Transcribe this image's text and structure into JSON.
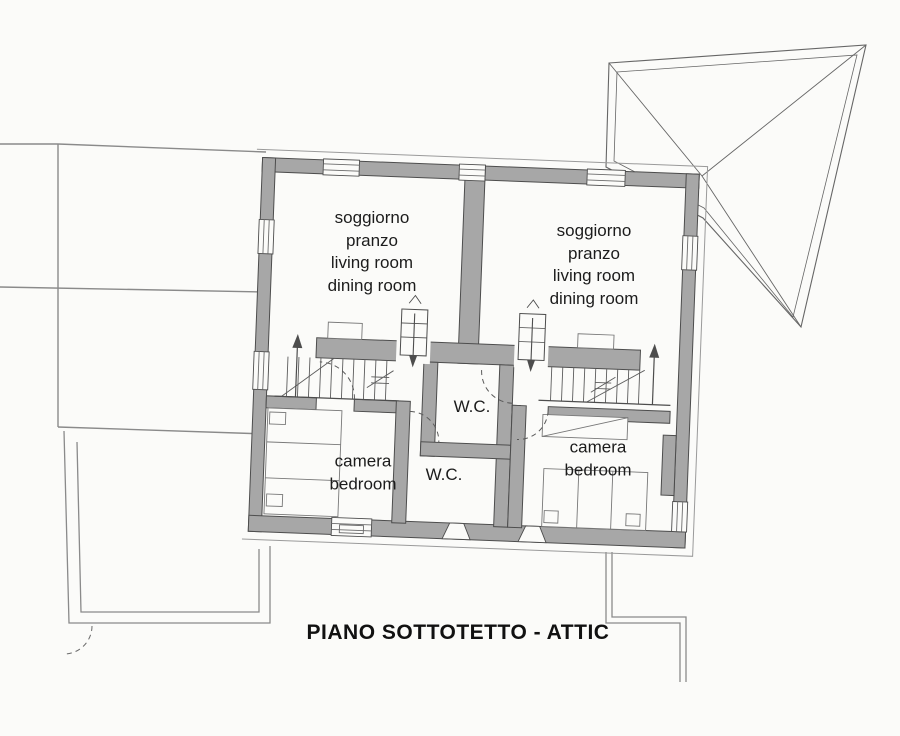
{
  "title": "PIANO SOTTOTETTO - ATTIC",
  "plan": {
    "rooms": [
      {
        "id": "soggiorno-left",
        "lines": [
          "soggiorno",
          "pranzo",
          "living room",
          "dining room"
        ]
      },
      {
        "id": "soggiorno-right",
        "lines": [
          "soggiorno",
          "pranzo",
          "living room",
          "dining room"
        ]
      },
      {
        "id": "wc-center",
        "lines": [
          "W.C."
        ]
      },
      {
        "id": "wc-lower",
        "lines": [
          "W.C."
        ]
      },
      {
        "id": "bedroom-left",
        "lines": [
          "camera",
          "bedroom"
        ]
      },
      {
        "id": "bedroom-right",
        "lines": [
          "camera",
          "bedroom"
        ]
      }
    ],
    "colors": {
      "wall_fill": "#a7a7a7",
      "line": "#4d4d4d",
      "thin_line": "#8a8a8a",
      "paper": "#fbfbf9",
      "text": "#1c1c1c"
    }
  }
}
